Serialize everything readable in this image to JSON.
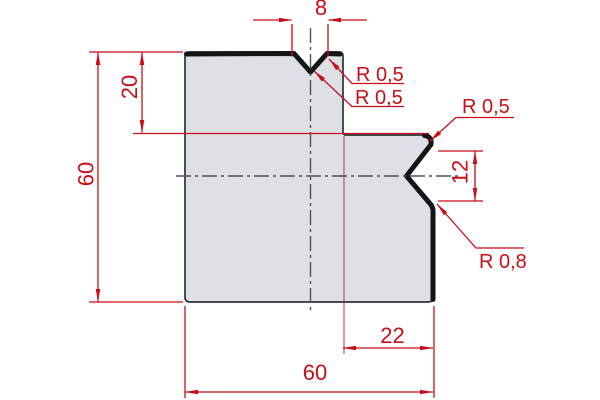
{
  "drawing_type": "press-brake-die-profile",
  "colors": {
    "dimension_red": "#c60f17",
    "part_fill": "#dde1e6",
    "outline_dark": "#141517",
    "outline_thin": "#2e3338",
    "centerline_gray": "#4d5156",
    "background": "#ffffff"
  },
  "dimensions": {
    "top_notch_width": "8",
    "shoulder_depth": "20",
    "total_height": "60",
    "side_notch_height": "12",
    "right_offset": "22",
    "total_width": "60"
  },
  "radii": {
    "top_notch_right": "R 0,5",
    "top_notch_apex": "R 0,5",
    "side_notch_top": "R 0,5",
    "side_notch_bottom": "R 0,8"
  }
}
